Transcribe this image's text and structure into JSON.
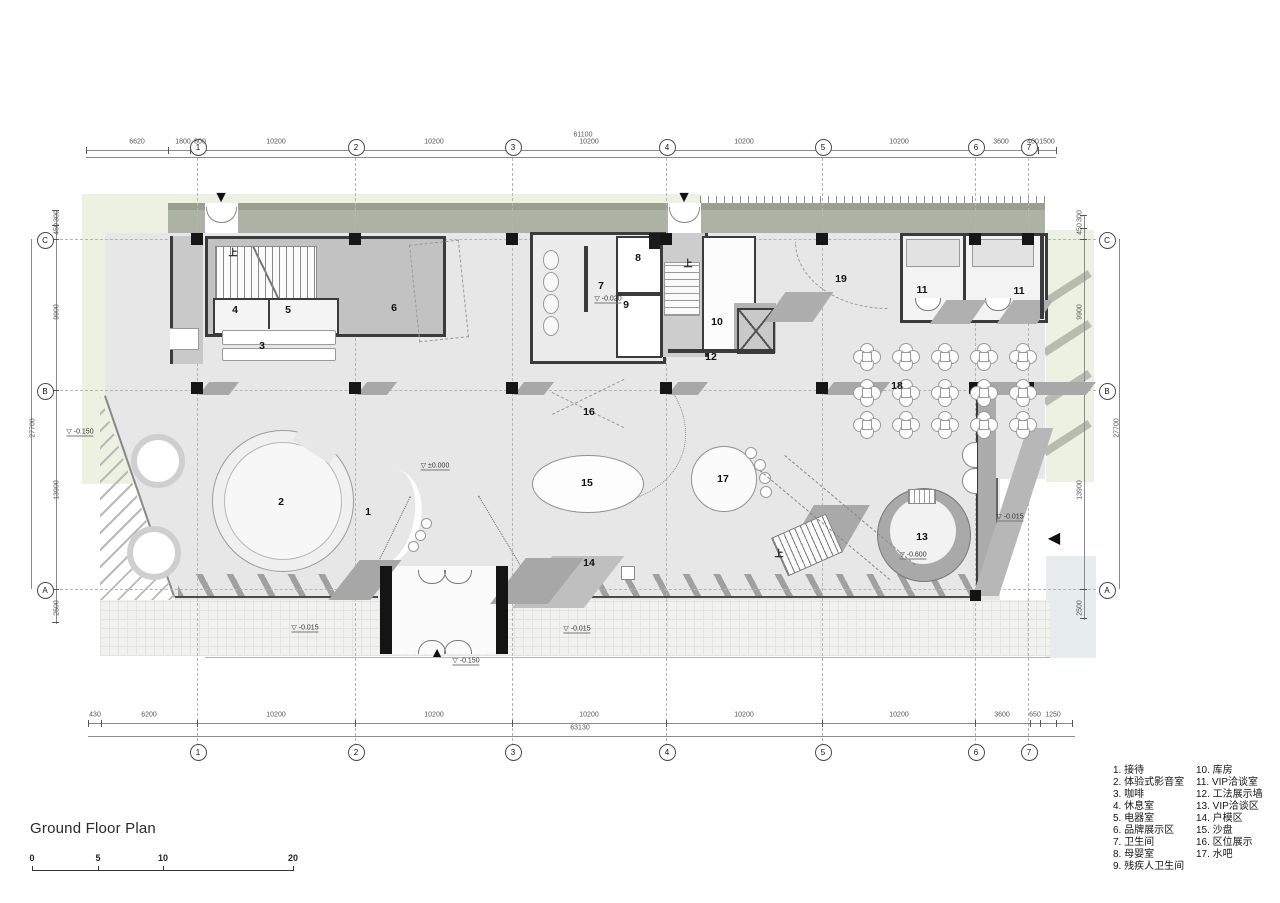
{
  "title": "Ground Floor Plan",
  "scalebar": {
    "labels": [
      "0",
      "5",
      "10",
      "20"
    ],
    "xs": [
      32,
      98,
      163,
      293
    ]
  },
  "legend": {
    "col1": [
      "1. 接待",
      "2. 体验式影音室",
      "3. 咖啡",
      "4. 休息室",
      "5. 电器室",
      "6. 品牌展示区",
      "7. 卫生间",
      "8. 母婴室",
      "9. 残疾人卫生间"
    ],
    "col2": [
      "10. 库房",
      "11. VIP洽谈室",
      "12. 工法展示墙",
      "13. VIP洽谈区",
      "14. 户模区",
      "15. 沙盘",
      "16. 区位展示",
      "17. 水吧"
    ]
  },
  "grid": {
    "top_y": 146,
    "bottom_y": 751,
    "left_x": 44,
    "right_x": 1106,
    "cols": [
      {
        "label": "1",
        "x": 197
      },
      {
        "label": "2",
        "x": 355
      },
      {
        "label": "3",
        "x": 512
      },
      {
        "label": "4",
        "x": 666
      },
      {
        "label": "5",
        "x": 822
      },
      {
        "label": "6",
        "x": 975
      },
      {
        "label": "7",
        "x": 1028
      }
    ],
    "rows": [
      {
        "label": "C",
        "y": 239
      },
      {
        "label": "B",
        "y": 390
      },
      {
        "label": "A",
        "y": 589
      }
    ]
  },
  "dims": {
    "top_y": 142,
    "top": [
      {
        "t": "6620",
        "x": 137
      },
      {
        "t": "1800",
        "x": 183
      },
      {
        "t": "800",
        "x": 200
      },
      {
        "t": "10200",
        "x": 276
      },
      {
        "t": "10200",
        "x": 434
      },
      {
        "t": "10200",
        "x": 589
      },
      {
        "t": "10200",
        "x": 744
      },
      {
        "t": "10200",
        "x": 899
      },
      {
        "t": "3600",
        "x": 1001
      },
      {
        "t": "400",
        "x": 1033
      },
      {
        "t": "1500",
        "x": 1047
      }
    ],
    "top_total": {
      "t": "61100",
      "x": 583,
      "y": 135
    },
    "bottom_y": 715,
    "bottom": [
      {
        "t": "430",
        "x": 95
      },
      {
        "t": "6200",
        "x": 149
      },
      {
        "t": "10200",
        "x": 276
      },
      {
        "t": "10200",
        "x": 434
      },
      {
        "t": "10200",
        "x": 589
      },
      {
        "t": "10200",
        "x": 744
      },
      {
        "t": "10200",
        "x": 899
      },
      {
        "t": "3600",
        "x": 1002
      },
      {
        "t": "650",
        "x": 1035
      },
      {
        "t": "1250",
        "x": 1053
      }
    ],
    "bottom_total": {
      "t": "63130",
      "x": 580,
      "y": 728
    },
    "left": [
      {
        "t": "300",
        "x": 57,
        "y": 216
      },
      {
        "t": "450",
        "x": 57,
        "y": 229
      },
      {
        "t": "9900",
        "x": 57,
        "y": 312
      },
      {
        "t": "13900",
        "x": 57,
        "y": 490
      },
      {
        "t": "2500",
        "x": 57,
        "y": 608
      },
      {
        "t": "27700",
        "x": 33,
        "y": 428
      }
    ],
    "right": [
      {
        "t": "300",
        "x": 1080,
        "y": 216
      },
      {
        "t": "450",
        "x": 1080,
        "y": 229
      },
      {
        "t": "9900",
        "x": 1080,
        "y": 312
      },
      {
        "t": "13900",
        "x": 1080,
        "y": 490
      },
      {
        "t": "2500",
        "x": 1080,
        "y": 608
      },
      {
        "t": "27700",
        "x": 1117,
        "y": 428
      }
    ]
  },
  "plan": {
    "stair_up_text": "上",
    "room_labels": [
      {
        "t": "1",
        "x": 368,
        "y": 512
      },
      {
        "t": "2",
        "x": 281,
        "y": 502
      },
      {
        "t": "3",
        "x": 262,
        "y": 346
      },
      {
        "t": "4",
        "x": 235,
        "y": 310
      },
      {
        "t": "5",
        "x": 288,
        "y": 310
      },
      {
        "t": "6",
        "x": 394,
        "y": 308
      },
      {
        "t": "7",
        "x": 601,
        "y": 286
      },
      {
        "t": "8",
        "x": 638,
        "y": 258
      },
      {
        "t": "9",
        "x": 626,
        "y": 305
      },
      {
        "t": "10",
        "x": 717,
        "y": 322
      },
      {
        "t": "11",
        "x": 922,
        "y": 290
      },
      {
        "t": "11",
        "x": 1019,
        "y": 291
      },
      {
        "t": "12",
        "x": 711,
        "y": 357
      },
      {
        "t": "13",
        "x": 922,
        "y": 537
      },
      {
        "t": "14",
        "x": 589,
        "y": 563
      },
      {
        "t": "15",
        "x": 587,
        "y": 483
      },
      {
        "t": "16",
        "x": 589,
        "y": 412
      },
      {
        "t": "17",
        "x": 723,
        "y": 479
      },
      {
        "t": "18",
        "x": 897,
        "y": 386
      },
      {
        "t": "19",
        "x": 841,
        "y": 279
      }
    ],
    "level_labels": [
      {
        "t": "±0.000",
        "x": 435,
        "y": 466
      },
      {
        "t": "-0.150",
        "x": 80,
        "y": 432
      },
      {
        "t": "-0.150",
        "x": 466,
        "y": 661
      },
      {
        "t": "-0.020",
        "x": 608,
        "y": 299
      },
      {
        "t": "-0.600",
        "x": 913,
        "y": 555
      },
      {
        "t": "-0.015",
        "x": 305,
        "y": 628
      },
      {
        "t": "-0.015",
        "x": 577,
        "y": 629
      },
      {
        "t": "-0.015",
        "x": 1010,
        "y": 517
      }
    ],
    "stair_labels": [
      {
        "x": 233,
        "y": 252
      },
      {
        "x": 688,
        "y": 263
      },
      {
        "x": 779,
        "y": 553
      }
    ],
    "entrance_arrows": [
      {
        "icon": "entrance_down",
        "x": 221,
        "y": 198
      },
      {
        "icon": "entrance_down",
        "x": 684,
        "y": 198
      },
      {
        "icon": "entrance_up",
        "x": 437,
        "y": 652
      },
      {
        "icon": "section_left",
        "x": 1054,
        "y": 538
      }
    ],
    "columns": {
      "xs": [
        197,
        355,
        512,
        666,
        822,
        975,
        1028
      ],
      "row1_y": 239,
      "row2_y": 388
    },
    "tables": {
      "xs": [
        866,
        905,
        944,
        983,
        1022
      ],
      "ys": [
        356,
        392,
        424
      ]
    }
  },
  "icons": {
    "level": "▽",
    "entrance_down": "▼",
    "entrance_up": "▲",
    "section_left": "◀"
  },
  "colors": {
    "pale_green": "#edf1e1",
    "pale_blue": "#e7ecef",
    "canopy": "#adb3a4",
    "canopy_dark": "#99a08f",
    "floor": "#e7e7e7",
    "pavement": "#f1f1ee",
    "wall": "#3b3b3b",
    "poche": "#bdbdbd",
    "column": "#161616",
    "dim_text": "#555555"
  }
}
